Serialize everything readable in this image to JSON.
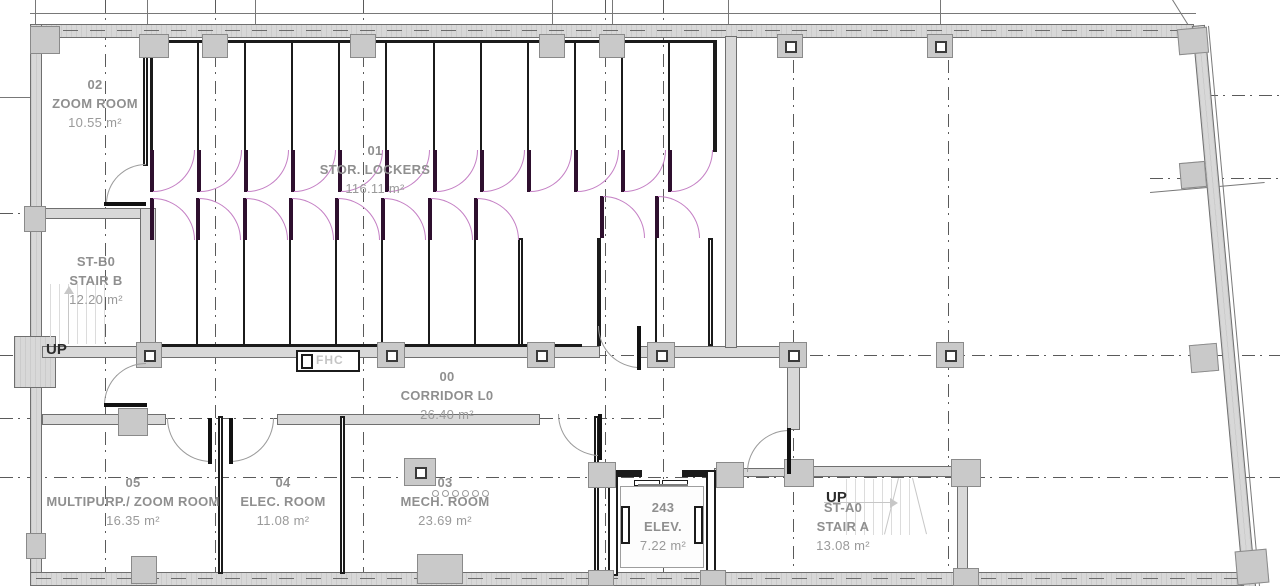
{
  "plan": {
    "rooms": [
      {
        "id": "02",
        "name": "ZOOM ROOM",
        "area": "10.55 m²"
      },
      {
        "id": "01",
        "name": "STOR. LOCKERS",
        "area": "116.11 m²"
      },
      {
        "id": "ST-B0",
        "name": "STAIR B",
        "area": "12.20 m²"
      },
      {
        "id": "00",
        "name": "CORRIDOR L0",
        "area": "26.40 m²"
      },
      {
        "id": "05",
        "name": "MULTIPURP./ ZOOM ROOM",
        "area": "16.35 m²"
      },
      {
        "id": "04",
        "name": "ELEC. ROOM",
        "area": "11.08 m²"
      },
      {
        "id": "03",
        "name": "MECH. ROOM",
        "area": "23.69 m²"
      },
      {
        "id": "243",
        "name": "ELEV.",
        "area": "7.22 m²"
      },
      {
        "id": "ST-A0",
        "name": "STAIR A",
        "area": "13.08 m²"
      }
    ],
    "annotations": {
      "stair_b_up": "UP",
      "stair_a_up": "UP",
      "fire_hose_cabinet": "FHC"
    },
    "lockers": {
      "top_row_stalls": 12,
      "bottom_row_a_stalls": 8,
      "bottom_row_b_stalls": 2
    },
    "colors": {
      "wall_fill": "#d8d8d8",
      "wall_edge": "#6f6f6f",
      "column_fill": "#c9c9c9",
      "partition": "#1b1b1b",
      "locker_door_leaf": "#2e0f2e",
      "locker_door_arc": "#c47fc4",
      "door_arc": "#9a9a9a",
      "door_leaf": "#111111",
      "grid": "#5a5a5a",
      "label_text": "#8f8f8f",
      "stair_faint": "#dcdcdc"
    }
  }
}
